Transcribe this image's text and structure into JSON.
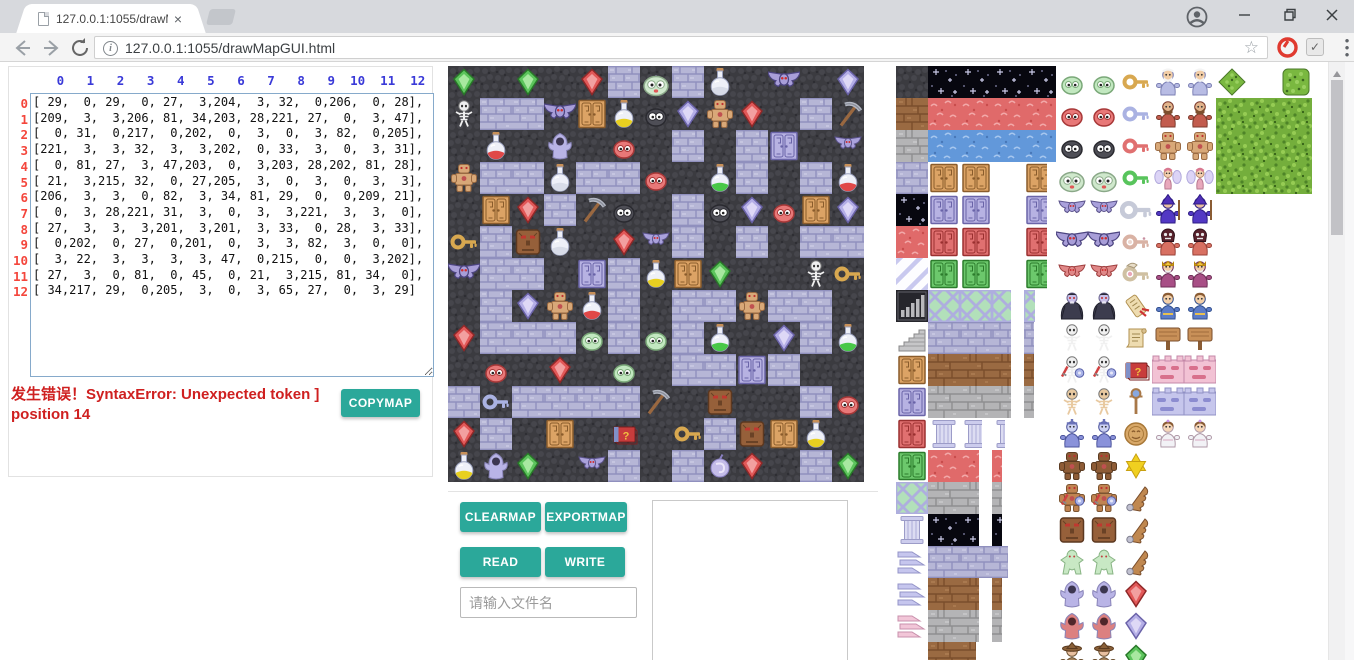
{
  "browser": {
    "tab": {
      "title": "127.0.0.1:1055/drawMa",
      "close_label": "×"
    },
    "url": "127.0.0.1:1055/drawMapGUI.html",
    "icons": [
      "document-favicon",
      "back-arrow-icon",
      "forward-arrow-icon",
      "reload-icon",
      "page-info-icon",
      "bookmark-star-icon",
      "adblock-hand-icon",
      "checkmark-extension-icon",
      "menu-dots-icon",
      "profile-icon",
      "minimize-icon",
      "restore-icon",
      "close-icon",
      "scrollbar-up-arrow"
    ]
  },
  "matrix_panel": {
    "col_headers": [
      0,
      1,
      2,
      3,
      4,
      5,
      6,
      7,
      8,
      9,
      10,
      11,
      12
    ],
    "row_headers": [
      0,
      1,
      2,
      3,
      4,
      5,
      6,
      7,
      8,
      9,
      10,
      11,
      12
    ],
    "matrix": [
      [
        29,
        0,
        29,
        0,
        27,
        3,
        204,
        3,
        32,
        0,
        206,
        0,
        28
      ],
      [
        209,
        3,
        3,
        206,
        81,
        34,
        203,
        28,
        221,
        27,
        0,
        3,
        47
      ],
      [
        0,
        31,
        0,
        217,
        0,
        202,
        0,
        3,
        0,
        3,
        82,
        0,
        205
      ],
      [
        221,
        3,
        3,
        32,
        3,
        3,
        202,
        0,
        33,
        3,
        0,
        3,
        31
      ],
      [
        0,
        81,
        27,
        3,
        47,
        203,
        0,
        3,
        203,
        28,
        202,
        81,
        28
      ],
      [
        21,
        3,
        215,
        32,
        0,
        27,
        205,
        3,
        0,
        3,
        0,
        3,
        3
      ],
      [
        206,
        3,
        3,
        0,
        82,
        3,
        34,
        81,
        29,
        0,
        0,
        209,
        21
      ],
      [
        0,
        3,
        28,
        221,
        31,
        3,
        0,
        3,
        3,
        221,
        3,
        3,
        0
      ],
      [
        27,
        3,
        3,
        3,
        201,
        3,
        201,
        3,
        33,
        0,
        28,
        3,
        33
      ],
      [
        0,
        202,
        0,
        27,
        0,
        201,
        0,
        3,
        3,
        82,
        3,
        0,
        0
      ],
      [
        3,
        22,
        3,
        3,
        3,
        3,
        47,
        0,
        215,
        0,
        0,
        3,
        202
      ],
      [
        27,
        3,
        0,
        81,
        0,
        45,
        0,
        21,
        3,
        215,
        81,
        34,
        0
      ],
      [
        34,
        217,
        29,
        0,
        205,
        3,
        0,
        3,
        65,
        27,
        0,
        3,
        29
      ]
    ],
    "error_text": "发生错误！SyntaxError: Unexpected token ] position 14",
    "copymap_label": "COPYMAP"
  },
  "controls": {
    "clearmap_label": "CLEARMAP",
    "exportmap_label": "EXPORTMAP",
    "read_label": "READ",
    "write_label": "WRITE",
    "filename_placeholder": "请输入文件名"
  },
  "map": {
    "tile_size": 32,
    "rows": 13,
    "cols": 13,
    "legend": {
      "0": "dark-floor",
      "3": "brick-path",
      "21": "yellow-key",
      "22": "blue-key",
      "27": "red-gem",
      "28": "blue-gem",
      "29": "green-gem",
      "31": "red-potion",
      "32": "white-potion",
      "33": "green-potion",
      "34": "yellow-potion",
      "45": "magic-book",
      "47": "pickaxe",
      "65": "magic-orb",
      "81": "yellow-door",
      "82": "blue-door",
      "201": "green-slime",
      "202": "red-slime",
      "203": "black-slime",
      "204": "slime-king",
      "205": "bat",
      "206": "big-bat",
      "209": "skeleton",
      "215": "stone-golem",
      "217": "ghost-priest",
      "221": "rock-warrior"
    }
  },
  "tileset": {
    "rows": [
      [
        "floor",
        "starbg",
        "starbg",
        "starbg",
        "starbg",
        "slime_g",
        "slime_g",
        "k_yel",
        "oldman",
        "oldman",
        "bush",
        null,
        "sqtree"
      ],
      [
        "dirt",
        "redbg",
        "redbg",
        "redbg",
        "redbg",
        "slime_r",
        "slime_r",
        "k_blu",
        "dwarf",
        "dwarf",
        "tree",
        "tree",
        "tree"
      ],
      [
        "stone",
        "water",
        "water",
        "water",
        "water",
        "slime_k",
        "slime_k",
        "k_red",
        "fighter",
        "fighter",
        "tree",
        "tree",
        "tree"
      ],
      [
        "brick",
        "d_tan",
        "d_tan",
        null,
        "d_tan:0.72",
        "slime_big",
        "slime_big",
        "k_grn",
        "fairy",
        "fairy",
        "tree",
        "tree",
        "tree"
      ],
      [
        "starbg",
        "d_lav",
        "d_lav",
        null,
        "d_lav:0.72",
        "bat",
        "bat",
        "k_gry",
        "wizard",
        "wizard",
        null,
        null,
        null
      ],
      [
        "redbg",
        "d_red",
        "d_red",
        null,
        "d_red:0.72",
        "bigbat",
        "bigbat",
        "k_orn",
        "priest",
        "priest",
        null,
        null,
        null
      ],
      [
        "diag",
        "d_grn",
        "d_grn",
        null,
        "d_grn:0.72",
        "redbat",
        "redbat",
        "k_wing",
        "king",
        "king",
        null,
        null,
        null
      ],
      [
        "bars",
        "lattice",
        "lattice",
        "lattice:0.6",
        "lattice:0.35",
        "vampire",
        "vampire",
        "scrollred",
        "prince",
        "prince",
        null,
        null,
        null
      ],
      [
        "stairs",
        "brick",
        "brick",
        "brick:0.6",
        "brick:0.3",
        "skel",
        "skel",
        "scroll",
        "sign",
        "sign",
        null,
        null,
        null
      ],
      [
        "d_tan",
        "dirt",
        "dirt",
        "dirt:0.6",
        "dirt:0.3",
        "skelwar",
        "skelwar",
        "book",
        "wallpink",
        "wallpink",
        null,
        null,
        null
      ],
      [
        "d_lav",
        "stone",
        "stone",
        "stone:0.6",
        "stone:0.3",
        "tanskel",
        "tanskel",
        "staff",
        "walllav",
        "walllav",
        null,
        null,
        null
      ],
      [
        "d_red",
        "pillar",
        "pillar:0.7",
        "pillar:0.4",
        null,
        "knight",
        "knight",
        "medal",
        "princess",
        "princess",
        null,
        null,
        null
      ],
      [
        "d_grn",
        "redbg",
        "redbg:0.6",
        "redbg:0.3",
        null,
        "bgolem",
        "bgolem",
        "star_i",
        null,
        null,
        null,
        null,
        null
      ],
      [
        "lattice",
        "stone",
        "stone:0.6",
        "stone:0.3",
        null,
        "golemwar",
        "golemwar",
        "wing",
        null,
        null,
        null,
        null,
        null
      ],
      [
        "pillar",
        "starbg",
        "starbg:0.6",
        "starbg:0.3",
        null,
        "stonef",
        "stonef",
        "wing",
        null,
        null,
        null,
        null,
        null
      ],
      [
        "wingl",
        "brick",
        "brick",
        "brick:0.5",
        null,
        "jelly",
        "jelly",
        "wing",
        null,
        null,
        null,
        null,
        null
      ],
      [
        "wingl",
        "dirt",
        "dirt:0.6",
        "dirt:0.3",
        null,
        "ghost",
        "ghost",
        "gem_r",
        null,
        null,
        null,
        null,
        null
      ],
      [
        "wingp",
        "stone",
        "stone:0.6",
        "stone:0.3",
        null,
        "ghostred",
        "ghostred",
        "gem_b",
        null,
        null,
        null,
        null,
        null
      ],
      [
        null,
        "dirt",
        "dirt:0.5",
        null,
        null,
        "hatwiz",
        "hatwiz",
        "gem_g",
        null,
        null,
        null,
        null,
        null
      ]
    ]
  }
}
